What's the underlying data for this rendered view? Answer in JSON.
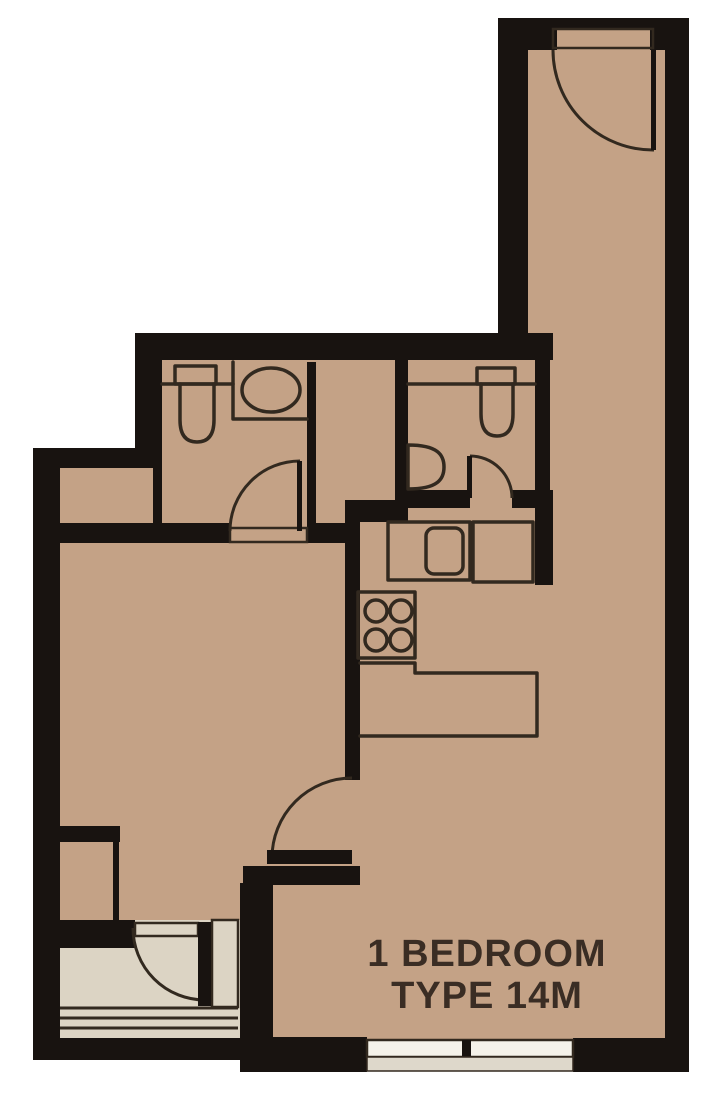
{
  "plan": {
    "title_line1": "1 BEDROOM",
    "title_line2": "TYPE 14M"
  },
  "colors": {
    "background": "#ffffff",
    "floor": "#c4a286",
    "balcony_floor": "#dcd4c4",
    "wall": "#181310",
    "line": "#32291f",
    "window_glass": "#f5f2ea",
    "window_sill": "#ded8cb",
    "text": "#3a2d24"
  },
  "fixtures": {
    "bathroom1": [
      "toilet",
      "counter-sink-oval"
    ],
    "bathroom2": [
      "toilet",
      "wall-mounted-sink"
    ],
    "kitchen": [
      "counter-sink",
      "side-counter",
      "stove-4-burner",
      "l-shaped-counter"
    ],
    "doors": [
      "entry-door",
      "bathroom1-door",
      "bathroom2-door",
      "bedroom-door",
      "balcony-door"
    ],
    "windows": [
      "living-room-window",
      "balcony-window",
      "balcony-sidelight"
    ]
  }
}
